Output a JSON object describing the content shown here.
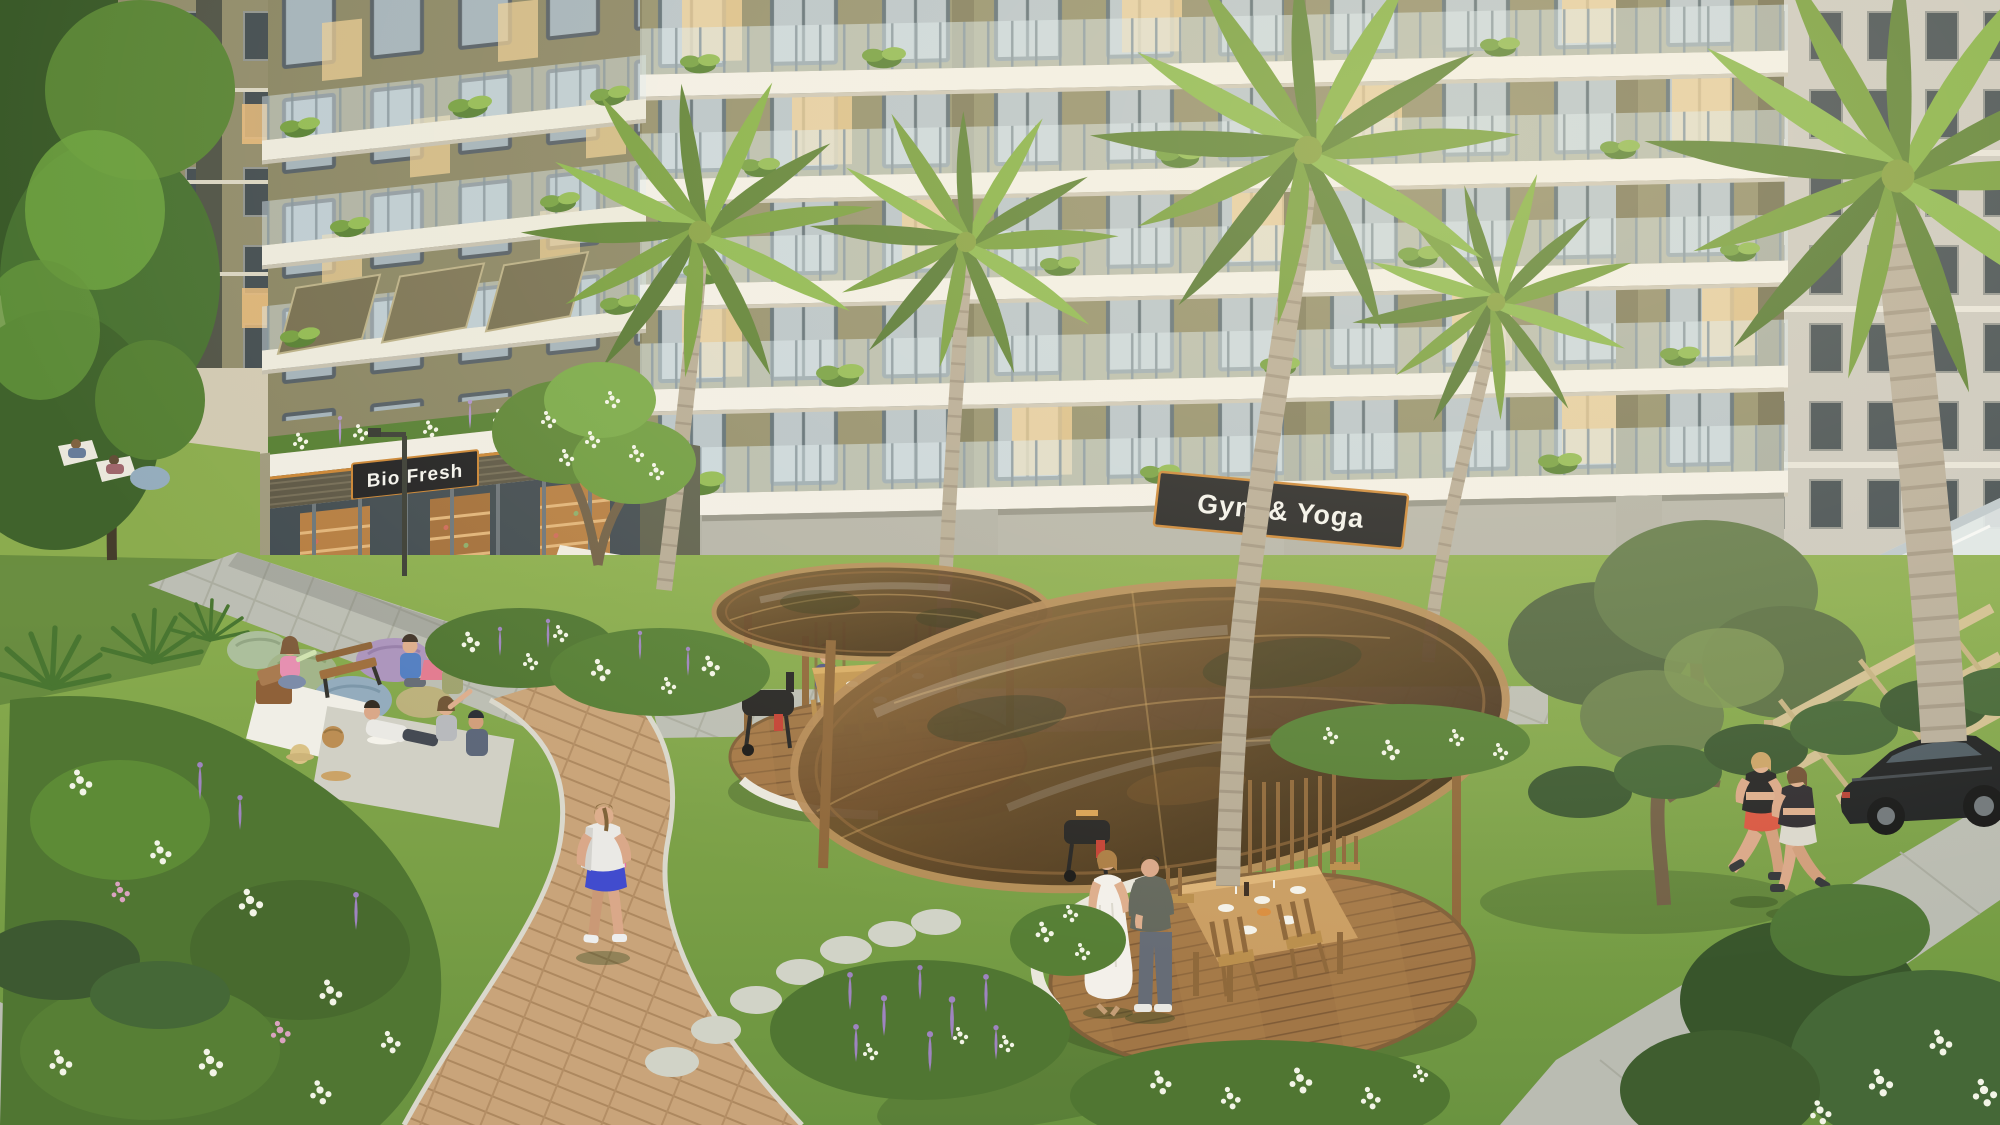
{
  "signs": {
    "store_sign": "Bio Fresh",
    "gym_sign": "Gym & Yoga"
  },
  "palette": {
    "sign_plate": "#17181b",
    "sign_trim": "#c9812e",
    "sign_text": "#f4f4f0",
    "facade_khaki": "#8e8a67",
    "slab_white": "#f2f0e9",
    "lawn_green": "#7aa843",
    "canopy_glass_brown": "#54371c",
    "wood_brown": "#8a6234",
    "path_brick": "#c7a176",
    "stone_gray": "#b2b2a8"
  }
}
